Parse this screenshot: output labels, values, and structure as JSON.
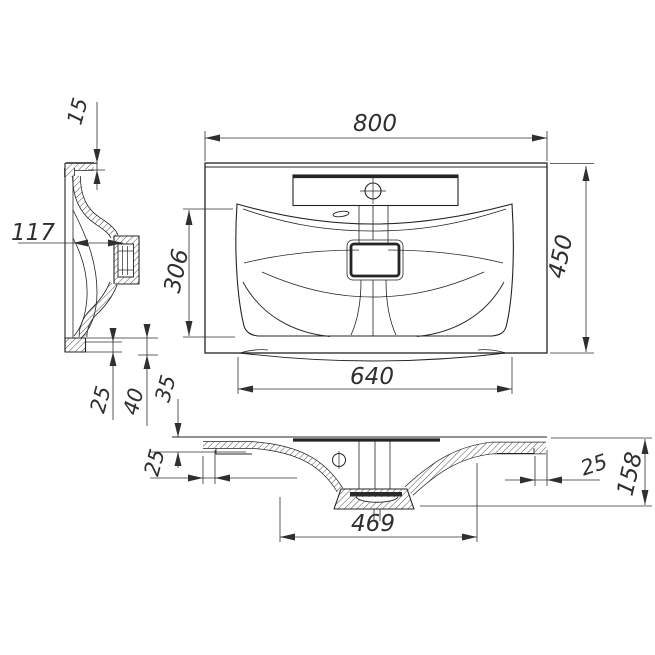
{
  "drawing": {
    "background_color": "#ffffff",
    "line_color": "#242424",
    "dim_color": "#2f2f2f",
    "dimensions": {
      "side_rim_thickness": "15",
      "side_depth": "117",
      "side_foot_small": "25",
      "side_foot_large": "40",
      "front_rim_drop": "35",
      "plan_width": "800",
      "plan_depth": "450",
      "basin_front_to_back": "306",
      "basin_width": "640",
      "front_left_inset": "25",
      "front_bowl_span": "469",
      "front_right_inset": "25",
      "front_total_height": "158"
    }
  }
}
